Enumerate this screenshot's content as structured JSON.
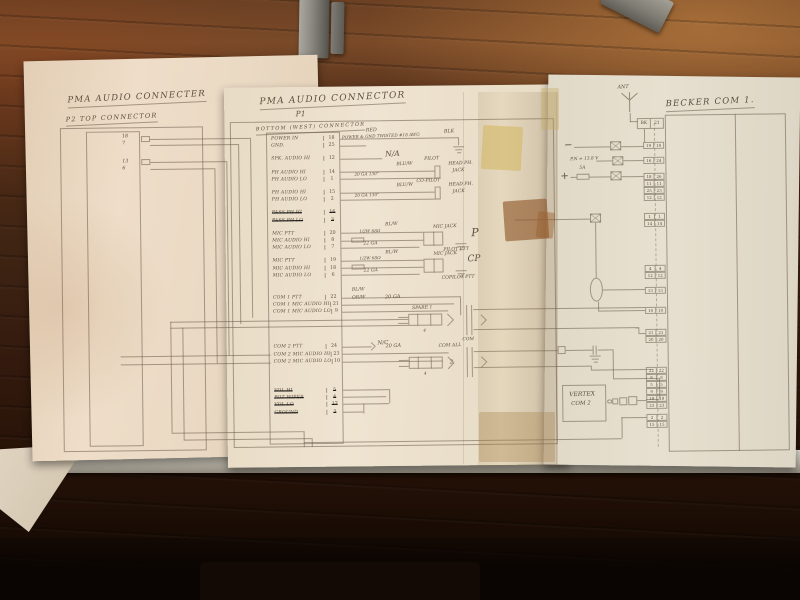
{
  "p2": {
    "title": "PMA AUDIO CONNECTER",
    "subtitle": "P2 TOP CONNECTOR",
    "pins": [
      {
        "n": "18"
      },
      {
        "n": "7"
      },
      {
        "n": "13",
        "cls": "m11"
      },
      {
        "n": "6"
      }
    ]
  },
  "p1": {
    "title": "PMA AUDIO CONNECTOR",
    "name": "P1",
    "subtitle": "BOTTOM (WEST) CONNECTOR",
    "rows": [
      {
        "label": "POWER IN",
        "pin": "18"
      },
      {
        "label": "GND.",
        "pin": "25"
      },
      {
        "label": "SPK. AUDIO HI",
        "pin": "12",
        "cls": "g1"
      },
      {
        "label": "PH AUDIO HI",
        "pin": "14",
        "cls": "g1"
      },
      {
        "label": "PH AUDIO LO",
        "pin": "1"
      },
      {
        "label": "PH AUDIO HI",
        "pin": "15",
        "cls": "g1"
      },
      {
        "label": "PH AUDIO LO",
        "pin": "2"
      },
      {
        "label": "PASS PH HI",
        "pin": "16",
        "cls": "g1 struck"
      },
      {
        "label": "PASS PH LO",
        "pin": "3",
        "cls": "struck"
      },
      {
        "label": "MIC PTT",
        "pin": "20",
        "cls": "g1"
      },
      {
        "label": "MIC AUDIO HI",
        "pin": "8"
      },
      {
        "label": "MIC AUDIO LO",
        "pin": "7"
      },
      {
        "label": "MIC PTT",
        "pin": "19",
        "cls": "g1"
      },
      {
        "label": "MIC AUDIO HI",
        "pin": "18"
      },
      {
        "label": "MIC AUDIO LO",
        "pin": "6"
      },
      {
        "label": "COM 1 PTT",
        "pin": "22",
        "cls": "g2"
      },
      {
        "label": "COM 1 MIC AUDIO HI",
        "pin": "21"
      },
      {
        "label": "COM 1 MIC AUDIO LO",
        "pin": "9"
      },
      {
        "label": "COM 2 PTT",
        "pin": "24",
        "cls": "g3"
      },
      {
        "label": "COM 2 MIC AUDIO HI",
        "pin": "23"
      },
      {
        "label": "COM 2 MIC AUDIO LO",
        "pin": "10"
      },
      {
        "label": "VOL HI",
        "pin": "5",
        "cls": "g4 struck"
      },
      {
        "label": "POT WIPER",
        "pin": "4",
        "cls": "struck"
      },
      {
        "label": "VOL LO",
        "pin": "17",
        "cls": "struck"
      },
      {
        "label": "GROUND",
        "pin": "3",
        "cls": "struck"
      }
    ]
  },
  "ann": {
    "red": "RED",
    "power_note": "POWER & GND TWISTED #18 AWG",
    "blk": "BLK",
    "na": "N/A",
    "bluw1": "BLU/W",
    "ga130_1": "20 GA 130\"",
    "pilot": "PILOT",
    "headph1": "HEAD PH.",
    "jackw1": "JACK",
    "bluw2": "BLU/W",
    "ga130_2": "20 GA 130\"",
    "copilot": "CO-PILOT",
    "headph2": "HEAD PH.",
    "jackw2": "JACK",
    "blw1": "BL/W",
    "res1": "1/2W 68Ω",
    "ga22_1": "22 GA",
    "micjack1": "MIC JACK",
    "p_tag": "P",
    "pilot_ptt": "PILOT PTT",
    "blw2": "BL/W",
    "res2": "1/2W 68Ω",
    "ga22_2": "22 GA",
    "micjack2": "MIC JACK",
    "cp_tag": "CP",
    "copilot_ptt": "COPILOT PTT",
    "blw3": "BL/W",
    "orw": "OR/W",
    "ga20_1": "20 GA",
    "spare1": "SPARE 1",
    "four_1": "4",
    "com_tag": "COM",
    "nc": "N/C",
    "ga20_2": "20 GA",
    "com_all": "COM ALL",
    "two_tag": "2",
    "four_2": "4"
  },
  "becker": {
    "title": "BECKER COM 1.",
    "ant": "ANT",
    "coax_a": "BK",
    "coax_b": "21",
    "minus": "−",
    "plus": "+",
    "supply": "P.N = 13.8 V",
    "fuse": "5A",
    "pairs": [
      {
        "a": "19",
        "b": "19"
      },
      {
        "a": "16",
        "b": "24",
        "cls": "m8"
      },
      {
        "a": "18",
        "b": "26",
        "cls": "m9"
      },
      {
        "a": "11",
        "b": "11"
      },
      {
        "a": "25",
        "b": "23"
      },
      {
        "a": "12",
        "b": "12"
      },
      {
        "a": "1",
        "b": "1",
        "cls": "m12"
      },
      {
        "a": "14",
        "b": "14"
      },
      {
        "a": "4",
        "b": "4",
        "cls": "m38"
      },
      {
        "a": "12",
        "b": "12"
      },
      {
        "a": "13",
        "b": "13",
        "cls": "m8"
      },
      {
        "a": "10",
        "b": "10",
        "cls": "m13"
      },
      {
        "a": "21",
        "b": "21",
        "cls": "m15"
      },
      {
        "a": "20",
        "b": "20"
      },
      {
        "a": "22",
        "b": "22",
        "cls": "m24"
      },
      {
        "a": "8",
        "b": "8"
      },
      {
        "a": "5",
        "b": "5"
      },
      {
        "a": "9",
        "b": "9"
      },
      {
        "a": "18",
        "b": "18"
      },
      {
        "a": "23",
        "b": "23"
      },
      {
        "a": "2",
        "b": "2",
        "cls": "m5"
      },
      {
        "a": "15",
        "b": "15"
      }
    ]
  },
  "vertex": {
    "line1": "VERTEX",
    "line2": "COM 2"
  }
}
